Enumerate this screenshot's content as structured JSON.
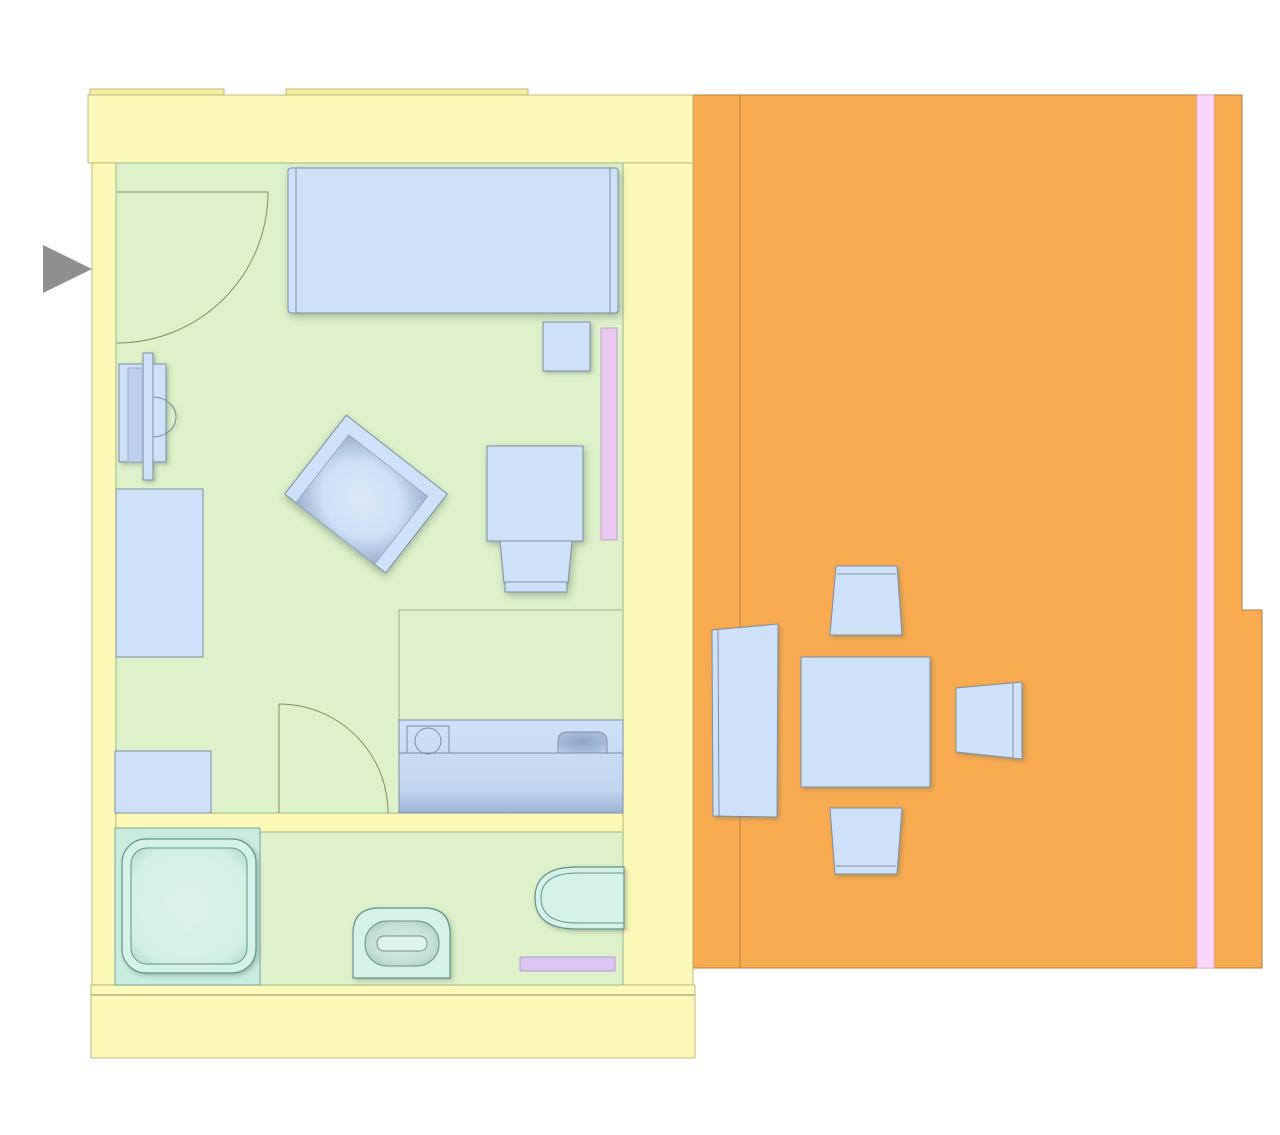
{
  "title": "studio-apartment-floor-plan",
  "colors": {
    "background": "#ffffff",
    "wall": "#fcf9b8",
    "wall-tab": "#f5eea1",
    "wall-line": "#b3aa6c",
    "floor": "#def1ca",
    "floor-line": "#9cb38b",
    "terrace": "#f9ab51",
    "terrace-line": "#b97f36",
    "furniture": "#cfe1f8",
    "furniture-line": "#7d8da4",
    "furniture-shade": "#93a9c9",
    "fixture": "#d6f1e7",
    "fixture-line": "#5f968a",
    "fixture-shade": "#a4c8bb",
    "shower-zone": "#c9ecdf",
    "curtain-pink": "#fbd6f9",
    "curtain-pink-line": "#d7a3cf",
    "curtain-lavender": "#e9c9f0",
    "radiator-lavender": "#dcc7f4",
    "entry-arrow": "#8f8f8f"
  },
  "rooms": [
    {
      "name": "living-bedroom",
      "floor": "floor"
    },
    {
      "name": "bathroom",
      "floor": "floor"
    },
    {
      "name": "terrace",
      "floor": "terrace"
    }
  ],
  "markers": [
    {
      "name": "entry-arrow",
      "shape": "triangle-right",
      "color": "entry-arrow"
    }
  ],
  "doors": [
    {
      "name": "entry-door",
      "type": "swing-90"
    },
    {
      "name": "bathroom-door",
      "type": "swing-90"
    }
  ],
  "furniture": {
    "living-bedroom": [
      {
        "name": "double-bed"
      },
      {
        "name": "nightstand"
      },
      {
        "name": "window-curtain-strip"
      },
      {
        "name": "armchair"
      },
      {
        "name": "desk"
      },
      {
        "name": "desk-chair"
      },
      {
        "name": "tv-unit"
      },
      {
        "name": "wardrobe"
      },
      {
        "name": "low-cabinet"
      },
      {
        "name": "kitchenette-counter"
      },
      {
        "name": "cooktop"
      },
      {
        "name": "kitchen-sink"
      }
    ],
    "bathroom": [
      {
        "name": "shower"
      },
      {
        "name": "toilet"
      },
      {
        "name": "washbasin"
      },
      {
        "name": "towel-radiator-strip"
      }
    ],
    "terrace": [
      {
        "name": "sun-lounger"
      },
      {
        "name": "terrace-table"
      },
      {
        "name": "terrace-chair-top"
      },
      {
        "name": "terrace-chair-bottom"
      },
      {
        "name": "terrace-chair-right"
      },
      {
        "name": "terrace-curtain-strip"
      }
    ]
  }
}
